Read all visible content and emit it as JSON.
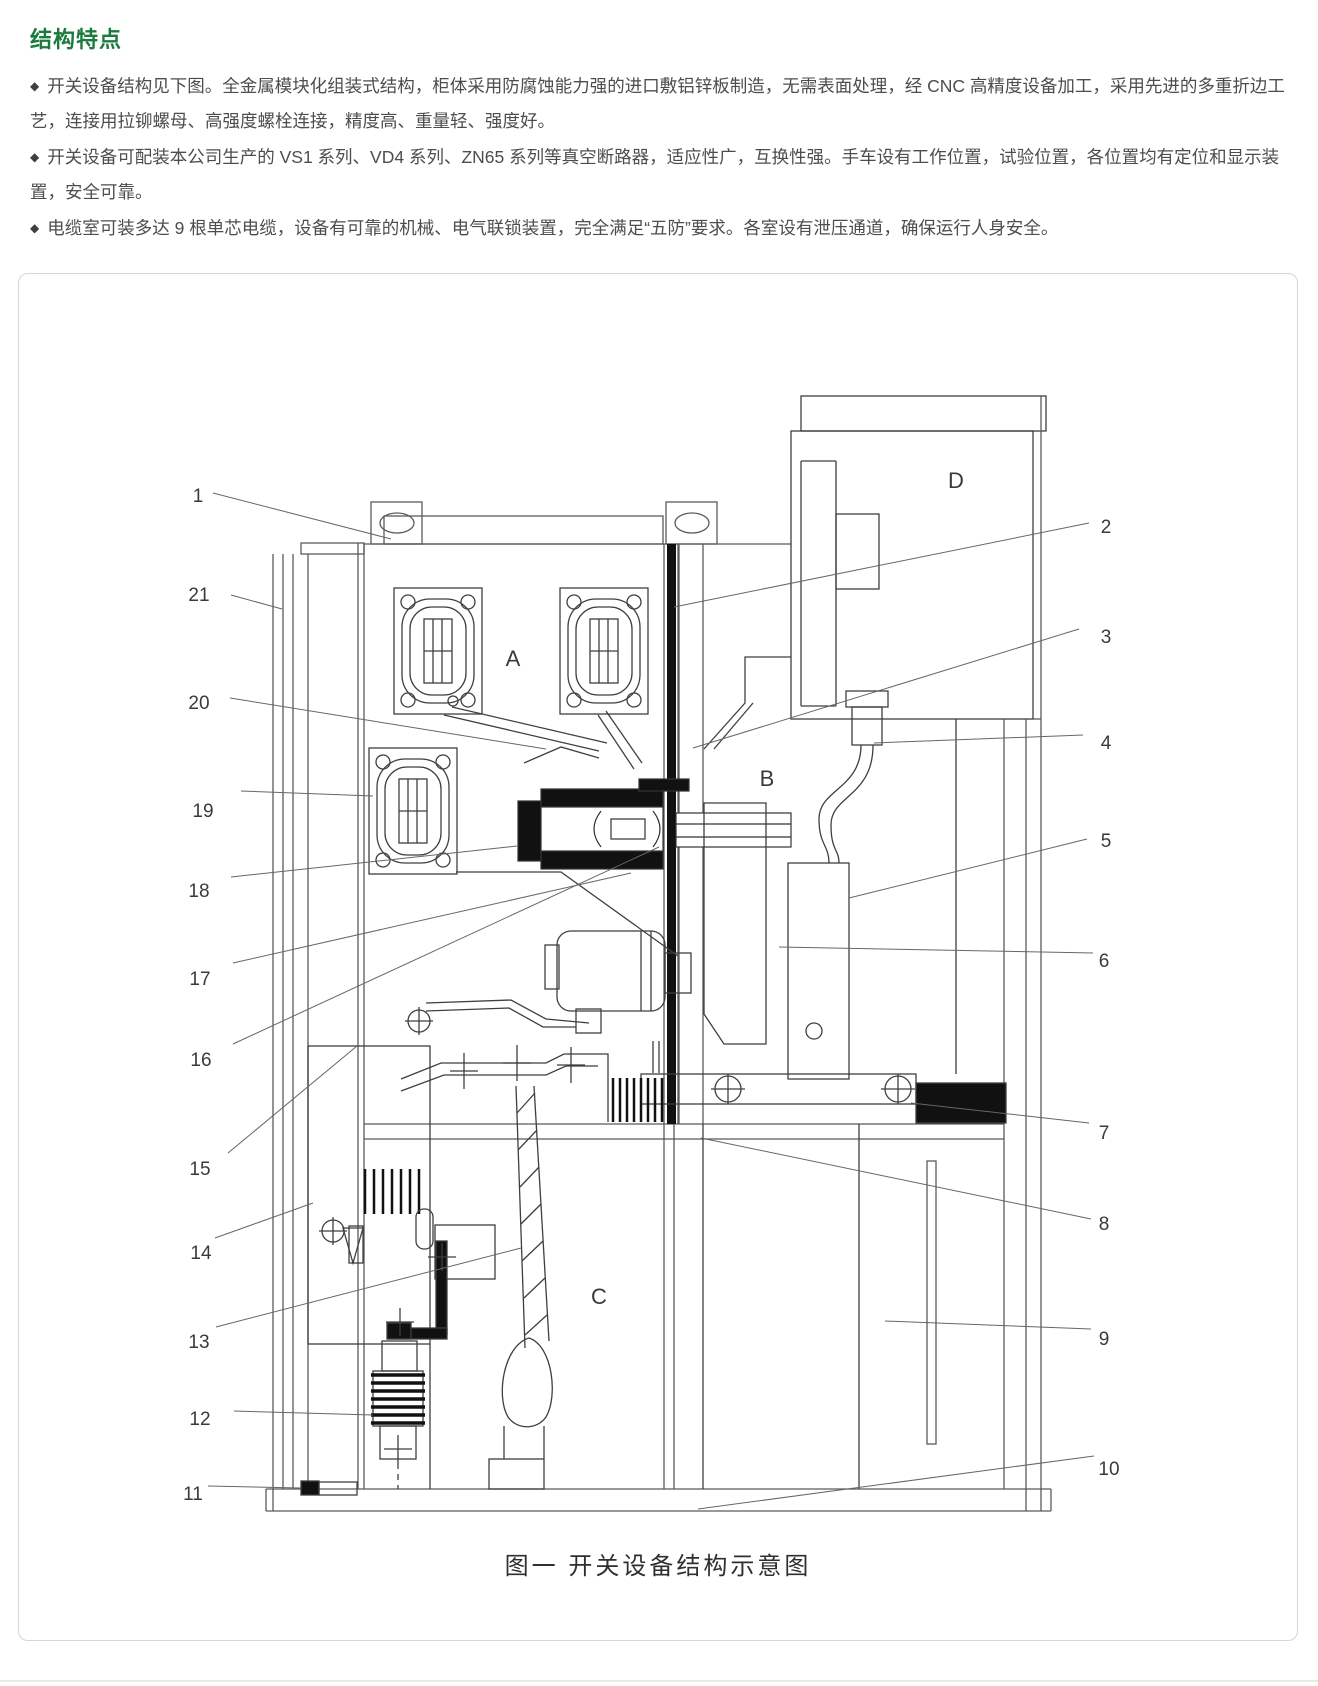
{
  "page": {
    "title": "结构特点",
    "accent_color": "#1b7a3d",
    "bullet_glyph": "◆"
  },
  "features": [
    {
      "text": "开关设备结构见下图。全金属模块化组装式结构，柜体采用防腐蚀能力强的进口敷铝锌板制造，无需表面处理，经 CNC 高精度设备加工，采用先进的多重折边工艺，连接用拉铆螺母、高强度螺栓连接，精度高、重量轻、强度好。"
    },
    {
      "text": "开关设备可配装本公司生产的 VS1 系列、VD4 系列、ZN65 系列等真空断路器，适应性广，互换性强。手车设有工作位置，试验位置，各位置均有定位和显示装置，安全可靠。"
    },
    {
      "text": "电缆室可装多达 9 根单芯电缆，设备有可靠的机械、电气联锁装置，完全满足“五防”要求。各室设有泄压通道，确保运行人身安全。"
    }
  ],
  "figure": {
    "caption": "图一 开关设备结构示意图",
    "compartments": {
      "a": "A",
      "b": "B",
      "c": "C",
      "d": "D"
    },
    "callouts": {
      "c1": "1",
      "c2": "2",
      "c3": "3",
      "c4": "4",
      "c5": "5",
      "c6": "6",
      "c7": "7",
      "c8": "8",
      "c9": "9",
      "c10": "10",
      "c11": "11",
      "c12": "12",
      "c13": "13",
      "c14": "14",
      "c15": "15",
      "c16": "16",
      "c17": "17",
      "c18": "18",
      "c19": "19",
      "c20": "20",
      "c21": "21"
    }
  }
}
